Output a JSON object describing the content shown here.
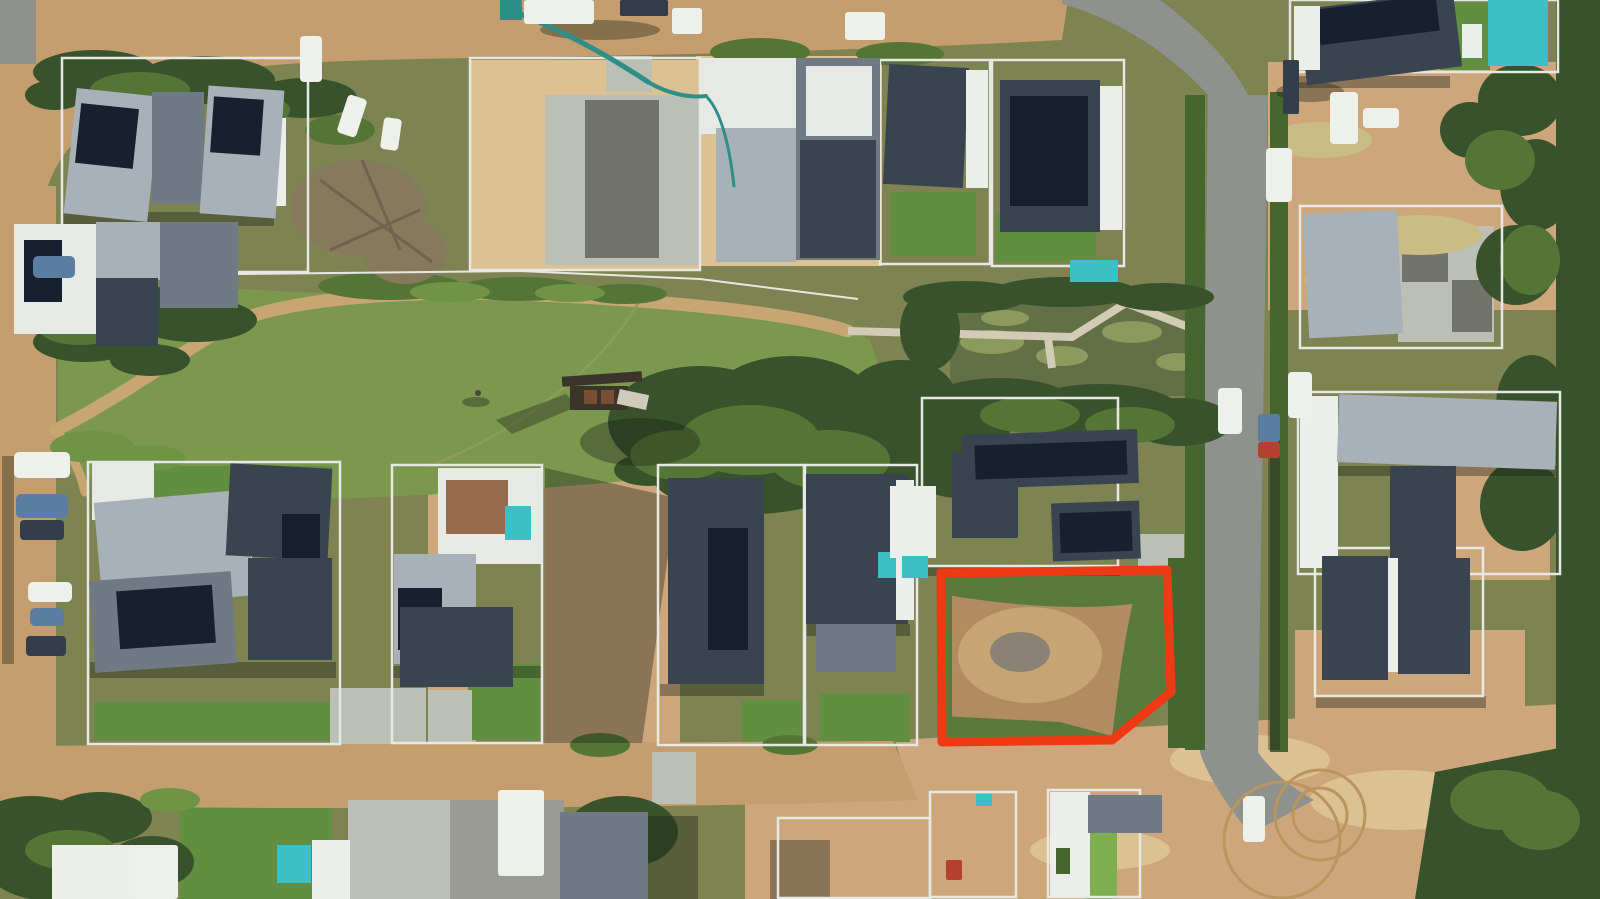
{
  "scene": {
    "description": "Top-down aerial drone photograph of a suburban residential security estate with a central green park, an ornamental pond with boardwalk, dirt and asphalt roads, houses with solar panels and pools, construction sites, and one vacant dirt plot highlighted with a thick red boundary near the bottom centre-right.",
    "view": "top-down aerial photo",
    "features": {
      "highlighted_plot": "vacant corner stand, bare dirt with grassy fringe, outlined in red with a chamfered lower-right corner",
      "park": "large green lawn with curved gravel path and timber playground",
      "pond": "murky green pond crossed by a light timber boardwalk",
      "construction": "several houses under construction with concrete pump, trucks and sand lots",
      "vehicles": "white vans and cars parked along roads, blue and dark cars on the left verge"
    }
  },
  "highlight": {
    "label": "vacant plot boundary",
    "color": "#ee3a14",
    "stroke_width": 9
  },
  "colors": {
    "base": "#7d8351",
    "dirt_road": "#c59e6f",
    "dirt_path": "#c8a673",
    "boardwalk": "#d2ccb6",
    "asphalt": "#8e918c",
    "concrete": "#bcbfb6",
    "slab": "#9a9c94",
    "slab_dark": "#72736c",
    "sand": "#cda77b",
    "sand_light": "#dcc193",
    "track": "#bb955e",
    "park_grass": "#7c984f",
    "lawn": "#628e41",
    "lawn_bright": "#7fae4f",
    "dry_grass": "#c9bc85",
    "trail": "#8e9c59",
    "tree_dark": "#38522b",
    "tree_mid": "#547536",
    "bush_light": "#6f9445",
    "hedge": "#46662f",
    "bare_tree": "#87795c",
    "branch": "#6f6450",
    "pond": "#636f45",
    "reeds": "#8d9a5e",
    "wall_white": "#eceee9",
    "fence_white": "#e6e8e3",
    "roof_white": "#e7e9e5",
    "roof_light": "#a8b1b8",
    "roof_mid": "#6f7a84",
    "roof_dark": "#3a4450",
    "solar": "#16202e",
    "pool": "#3cc0c5",
    "brick": "#976a4e",
    "veh_white": "#eef0ec",
    "veh_blue": "#5b7da1",
    "veh_dark": "#333e4a",
    "veh_red": "#b5402e",
    "machinery_teal": "#2e8e88",
    "shadow": "#1c2317",
    "plot_dirt": "#b08c60",
    "plot_dirt_light": "#c7a473",
    "plot_gray": "#8a8274",
    "plot_green": "#5a7a3c",
    "timber": "#3a342a",
    "timber_brown": "#7a4e35",
    "ramp": "#cfcabb",
    "person": "#4a443c"
  }
}
